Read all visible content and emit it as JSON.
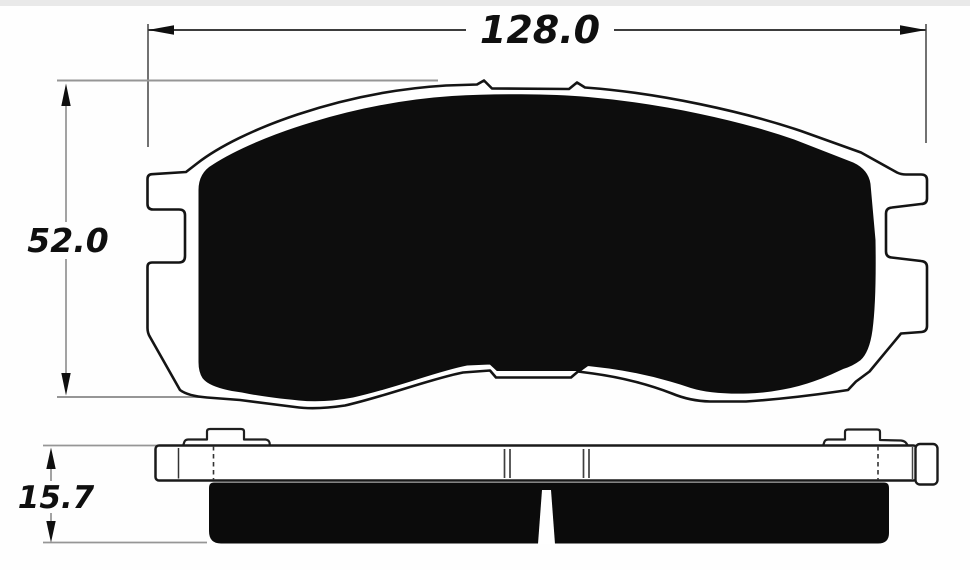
{
  "drawing": {
    "subject": "brake-pad-technical-drawing",
    "background": "#ffffff",
    "outline_color": "#141414",
    "friction_fill_color": "#0d0d0d",
    "dim_gray_line_color": "#969696",
    "dim_dark_line_color": "#3d3d3d",
    "views": {
      "front_view": {
        "name": "pad front profile"
      },
      "side_view": {
        "name": "pad side profile"
      }
    },
    "dimensions": [
      {
        "id": "width",
        "label": "128.0",
        "orientation": "horizontal"
      },
      {
        "id": "height",
        "label": "52.0",
        "orientation": "vertical"
      },
      {
        "id": "thickness",
        "label": "15.7",
        "orientation": "vertical"
      }
    ]
  }
}
